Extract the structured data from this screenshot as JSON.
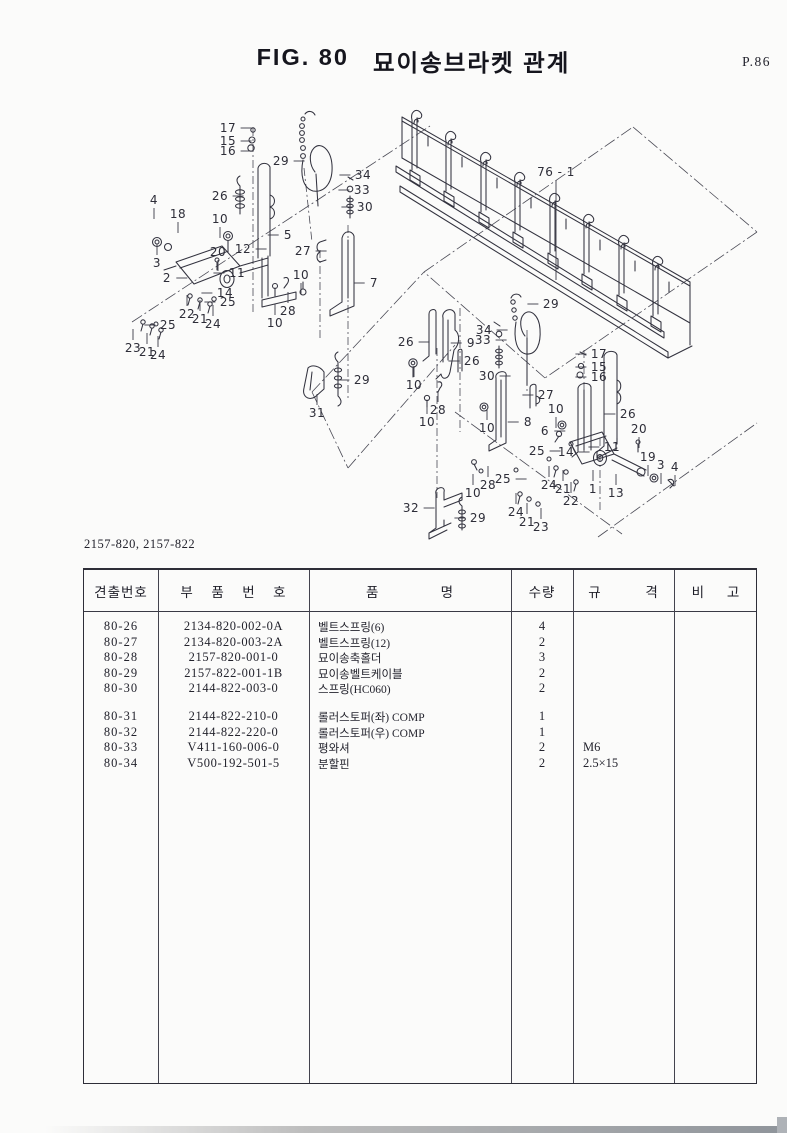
{
  "page": {
    "figure_label": "FIG. 80",
    "figure_title": "묘이송브라켓 관계",
    "page_number": "P.86",
    "model_codes": "2157-820, 2157-822"
  },
  "diagram": {
    "callouts": [
      {
        "label": "17",
        "x": 228,
        "y": 128,
        "dir": "r"
      },
      {
        "label": "15",
        "x": 228,
        "y": 141,
        "dir": "r"
      },
      {
        "label": "16",
        "x": 228,
        "y": 151,
        "dir": "r"
      },
      {
        "label": "29",
        "x": 281,
        "y": 161,
        "dir": "r"
      },
      {
        "label": "26",
        "x": 220,
        "y": 196,
        "dir": "r"
      },
      {
        "label": "34",
        "x": 363,
        "y": 175,
        "dir": "l"
      },
      {
        "label": "33",
        "x": 362,
        "y": 190,
        "dir": "l"
      },
      {
        "label": "30",
        "x": 365,
        "y": 207,
        "dir": "l"
      },
      {
        "label": "4",
        "x": 154,
        "y": 200,
        "dir": "d"
      },
      {
        "label": "18",
        "x": 178,
        "y": 214,
        "dir": "d"
      },
      {
        "label": "10",
        "x": 220,
        "y": 219,
        "dir": "d"
      },
      {
        "label": "3",
        "x": 157,
        "y": 263,
        "dir": "u"
      },
      {
        "label": "5",
        "x": 288,
        "y": 235,
        "dir": "l"
      },
      {
        "label": "12",
        "x": 243,
        "y": 249,
        "dir": "r"
      },
      {
        "label": "20",
        "x": 218,
        "y": 252,
        "dir": "d"
      },
      {
        "label": "27",
        "x": 303,
        "y": 251,
        "dir": "r"
      },
      {
        "label": "2",
        "x": 167,
        "y": 278,
        "dir": "r"
      },
      {
        "label": "11",
        "x": 237,
        "y": 273,
        "dir": "l"
      },
      {
        "label": "14",
        "x": 225,
        "y": 293,
        "dir": "l"
      },
      {
        "label": "25",
        "x": 228,
        "y": 302,
        "dir": "l"
      },
      {
        "label": "22",
        "x": 187,
        "y": 314,
        "dir": "u"
      },
      {
        "label": "21",
        "x": 200,
        "y": 319,
        "dir": "u"
      },
      {
        "label": "24",
        "x": 213,
        "y": 324,
        "dir": "u"
      },
      {
        "label": "28",
        "x": 288,
        "y": 311,
        "dir": "u"
      },
      {
        "label": "10",
        "x": 275,
        "y": 323,
        "dir": "u"
      },
      {
        "label": "10",
        "x": 301,
        "y": 275,
        "dir": "d"
      },
      {
        "label": "25",
        "x": 168,
        "y": 325,
        "dir": "l"
      },
      {
        "label": "23",
        "x": 133,
        "y": 348,
        "dir": "u"
      },
      {
        "label": "21",
        "x": 147,
        "y": 352,
        "dir": "u"
      },
      {
        "label": "24",
        "x": 158,
        "y": 355,
        "dir": "u"
      },
      {
        "label": "7",
        "x": 374,
        "y": 283,
        "dir": "l"
      },
      {
        "label": "76 - 1",
        "x": 556,
        "y": 172,
        "dir": "d",
        "len": 100
      },
      {
        "label": "29",
        "x": 551,
        "y": 304,
        "dir": "l"
      },
      {
        "label": "26",
        "x": 406,
        "y": 342,
        "dir": "r"
      },
      {
        "label": "9",
        "x": 471,
        "y": 343,
        "dir": "l"
      },
      {
        "label": "34",
        "x": 484,
        "y": 330,
        "dir": "r"
      },
      {
        "label": "33",
        "x": 483,
        "y": 340,
        "dir": "r"
      },
      {
        "label": "26",
        "x": 472,
        "y": 361,
        "dir": "l"
      },
      {
        "label": "30",
        "x": 487,
        "y": 376,
        "dir": "r"
      },
      {
        "label": "10",
        "x": 414,
        "y": 385,
        "dir": "u"
      },
      {
        "label": "28",
        "x": 438,
        "y": 410,
        "dir": "u"
      },
      {
        "label": "10",
        "x": 427,
        "y": 422,
        "dir": "u"
      },
      {
        "label": "31",
        "x": 317,
        "y": 413,
        "dir": "u"
      },
      {
        "label": "29",
        "x": 362,
        "y": 380,
        "dir": "l"
      },
      {
        "label": "10",
        "x": 487,
        "y": 428,
        "dir": "u"
      },
      {
        "label": "8",
        "x": 528,
        "y": 422,
        "dir": "l"
      },
      {
        "label": "27",
        "x": 546,
        "y": 395,
        "dir": "l"
      },
      {
        "label": "10",
        "x": 556,
        "y": 409,
        "dir": "d"
      },
      {
        "label": "6",
        "x": 545,
        "y": 431,
        "dir": "r"
      },
      {
        "label": "17",
        "x": 599,
        "y": 354,
        "dir": "l"
      },
      {
        "label": "15",
        "x": 599,
        "y": 367,
        "dir": "l"
      },
      {
        "label": "16",
        "x": 599,
        "y": 377,
        "dir": "l"
      },
      {
        "label": "26",
        "x": 628,
        "y": 414,
        "dir": "l"
      },
      {
        "label": "20",
        "x": 639,
        "y": 429,
        "dir": "d"
      },
      {
        "label": "11",
        "x": 612,
        "y": 447,
        "dir": "l"
      },
      {
        "label": "25",
        "x": 537,
        "y": 451,
        "dir": "r"
      },
      {
        "label": "14",
        "x": 566,
        "y": 452,
        "dir": "r"
      },
      {
        "label": "19",
        "x": 648,
        "y": 457,
        "dir": "d"
      },
      {
        "label": "3",
        "x": 661,
        "y": 465,
        "dir": "d"
      },
      {
        "label": "4",
        "x": 675,
        "y": 467,
        "dir": "d"
      },
      {
        "label": "24",
        "x": 549,
        "y": 485,
        "dir": "u"
      },
      {
        "label": "21",
        "x": 563,
        "y": 489,
        "dir": "u"
      },
      {
        "label": "22",
        "x": 571,
        "y": 501,
        "dir": "u"
      },
      {
        "label": "1",
        "x": 593,
        "y": 489,
        "dir": "u"
      },
      {
        "label": "13",
        "x": 616,
        "y": 493,
        "dir": "u"
      },
      {
        "label": "25",
        "x": 503,
        "y": 479,
        "dir": "r"
      },
      {
        "label": "32",
        "x": 411,
        "y": 508,
        "dir": "r"
      },
      {
        "label": "28",
        "x": 488,
        "y": 485,
        "dir": "u"
      },
      {
        "label": "10",
        "x": 473,
        "y": 493,
        "dir": "u"
      },
      {
        "label": "29",
        "x": 478,
        "y": 518,
        "dir": "l"
      },
      {
        "label": "24",
        "x": 516,
        "y": 512,
        "dir": "u"
      },
      {
        "label": "21",
        "x": 527,
        "y": 522,
        "dir": "u"
      },
      {
        "label": "23",
        "x": 541,
        "y": 527,
        "dir": "u"
      }
    ]
  },
  "table": {
    "headers": [
      "견출번호",
      "부    품    번    호",
      "품              명",
      "수량",
      "규          격",
      "비     고"
    ],
    "row_groups": [
      [
        {
          "no": "80-26",
          "part_no": "2134-820-002-0A",
          "name": "벨트스프링(6)",
          "qty": "4",
          "spec": "",
          "note": ""
        },
        {
          "no": "80-27",
          "part_no": "2134-820-003-2A",
          "name": "벨트스프링(12)",
          "qty": "2",
          "spec": "",
          "note": ""
        },
        {
          "no": "80-28",
          "part_no": "2157-820-001-0",
          "name": "묘이송축홀더",
          "qty": "3",
          "spec": "",
          "note": ""
        },
        {
          "no": "80-29",
          "part_no": "2157-822-001-1B",
          "name": "묘이송벨트케이블",
          "qty": "2",
          "spec": "",
          "note": ""
        },
        {
          "no": "80-30",
          "part_no": "2144-822-003-0",
          "name": "스프링(HC060)",
          "qty": "2",
          "spec": "",
          "note": ""
        }
      ],
      [
        {
          "no": "80-31",
          "part_no": "2144-822-210-0",
          "name": "롤러스토퍼(좌) COMP",
          "qty": "1",
          "spec": "",
          "note": ""
        },
        {
          "no": "80-32",
          "part_no": "2144-822-220-0",
          "name": "롤러스토퍼(우) COMP",
          "qty": "1",
          "spec": "",
          "note": ""
        },
        {
          "no": "80-33",
          "part_no": "V411-160-006-0",
          "name": "평와셔",
          "qty": "2",
          "spec": "M6",
          "note": ""
        },
        {
          "no": "80-34",
          "part_no": "V500-192-501-5",
          "name": "분할핀",
          "qty": "2",
          "spec": "2.5×15",
          "note": ""
        }
      ]
    ]
  }
}
